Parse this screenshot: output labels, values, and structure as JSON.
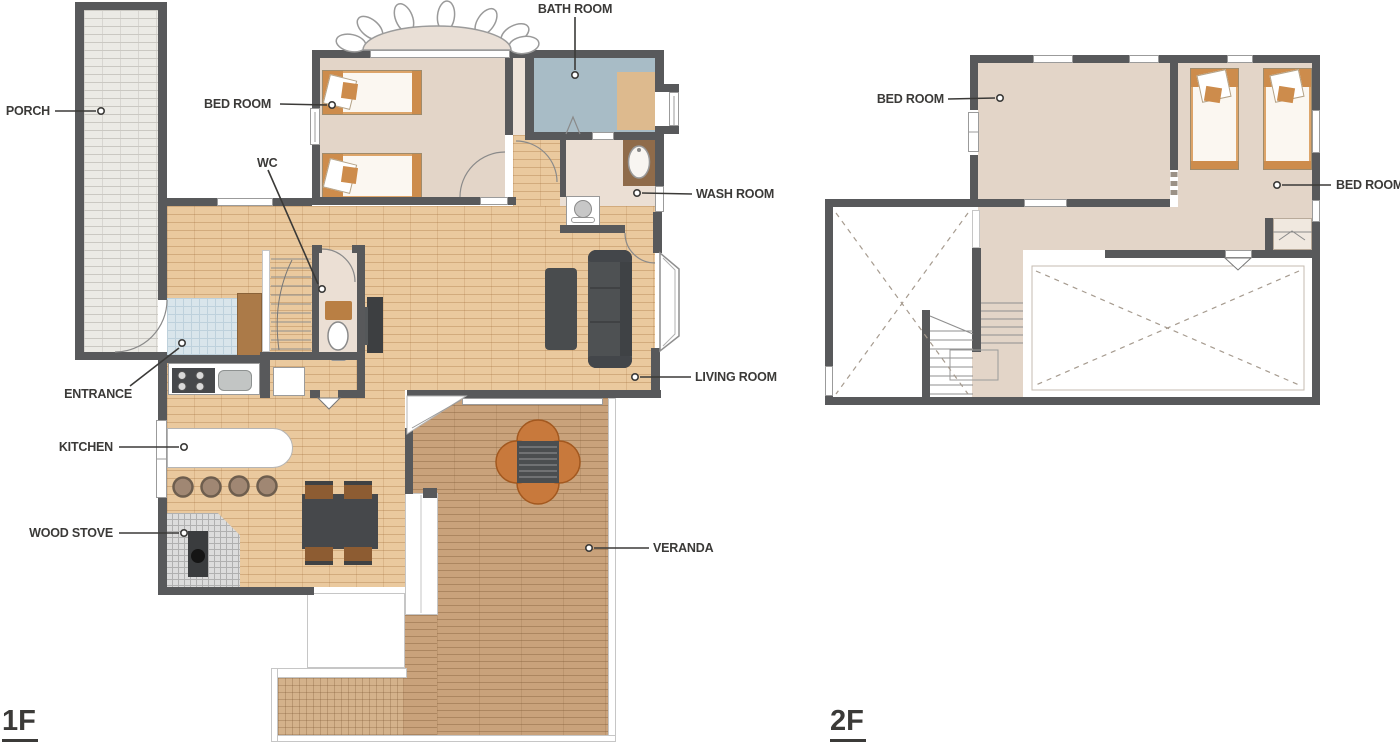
{
  "meta": {
    "type": "floor-plan",
    "floors": [
      "1F",
      "2F"
    ]
  },
  "colors": {
    "wall": "#58595b",
    "wood_floor": "#eac99e",
    "room_floor": "#e3d5c8",
    "bath_floor": "#a8bcc6",
    "entrance_tile": "#d9e5eb",
    "porch_brick": "#ebeae5",
    "veranda_deck": "#c9a27b",
    "furniture_accent": "#cd8c4c",
    "label_text": "#3b3a38"
  },
  "floor1": {
    "title": "1F",
    "labels": {
      "porch": "PORCH",
      "bedroom": "BED ROOM",
      "bathroom": "BATH ROOM",
      "wc": "WC",
      "washroom": "WASH ROOM",
      "entrance": "ENTRANCE",
      "living_room": "LIVING ROOM",
      "kitchen": "KITCHEN",
      "wood_stove": "WOOD STOVE",
      "veranda": "VERANDA"
    }
  },
  "floor2": {
    "title": "2F",
    "labels": {
      "bedroom_left": "BED ROOM",
      "bedroom_right": "BED ROOM"
    }
  }
}
